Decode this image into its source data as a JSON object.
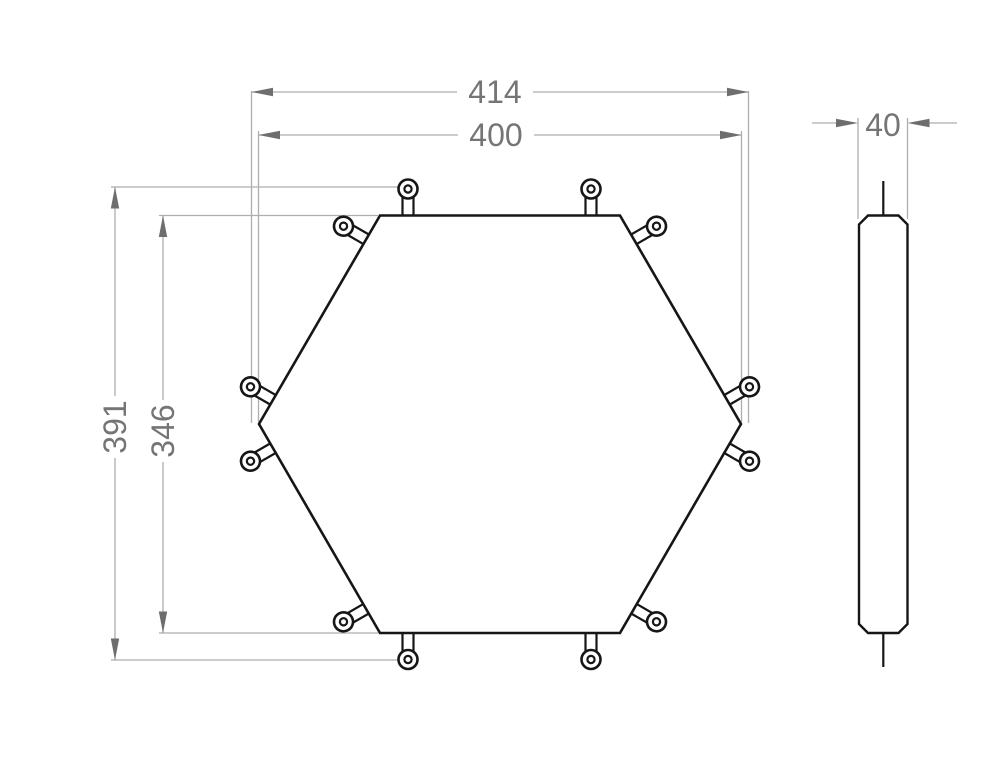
{
  "page": {
    "type": "technical-drawing",
    "subject": "Hexagonal plate with twelve pin tabs — top view and side view",
    "background": "#ffffff"
  },
  "colors": {
    "part_outline": "#161616",
    "dimension_line": "#aeaeae",
    "dimension_arrow": "#6e6e6e",
    "dimension_text": "#757575"
  },
  "dimensions": {
    "overall_width": {
      "label": "414",
      "value": 414,
      "orientation": "horizontal"
    },
    "width_across_corners": {
      "label": "400",
      "value": 400,
      "orientation": "horizontal"
    },
    "overall_height": {
      "label": "391",
      "value": 391,
      "orientation": "vertical"
    },
    "height_across_flats": {
      "label": "346",
      "value": 346,
      "orientation": "vertical"
    },
    "thickness": {
      "label": "40",
      "value": 40,
      "orientation": "horizontal"
    }
  },
  "views": {
    "top_view": {
      "shape": "regular hexagon, flat top",
      "tab_count": 12,
      "tabs_per_edge": 2,
      "tab_feature": "round lug with center hole"
    },
    "side_view": {
      "shape": "slim chamfered bar with center pin lines at top and bottom"
    }
  }
}
